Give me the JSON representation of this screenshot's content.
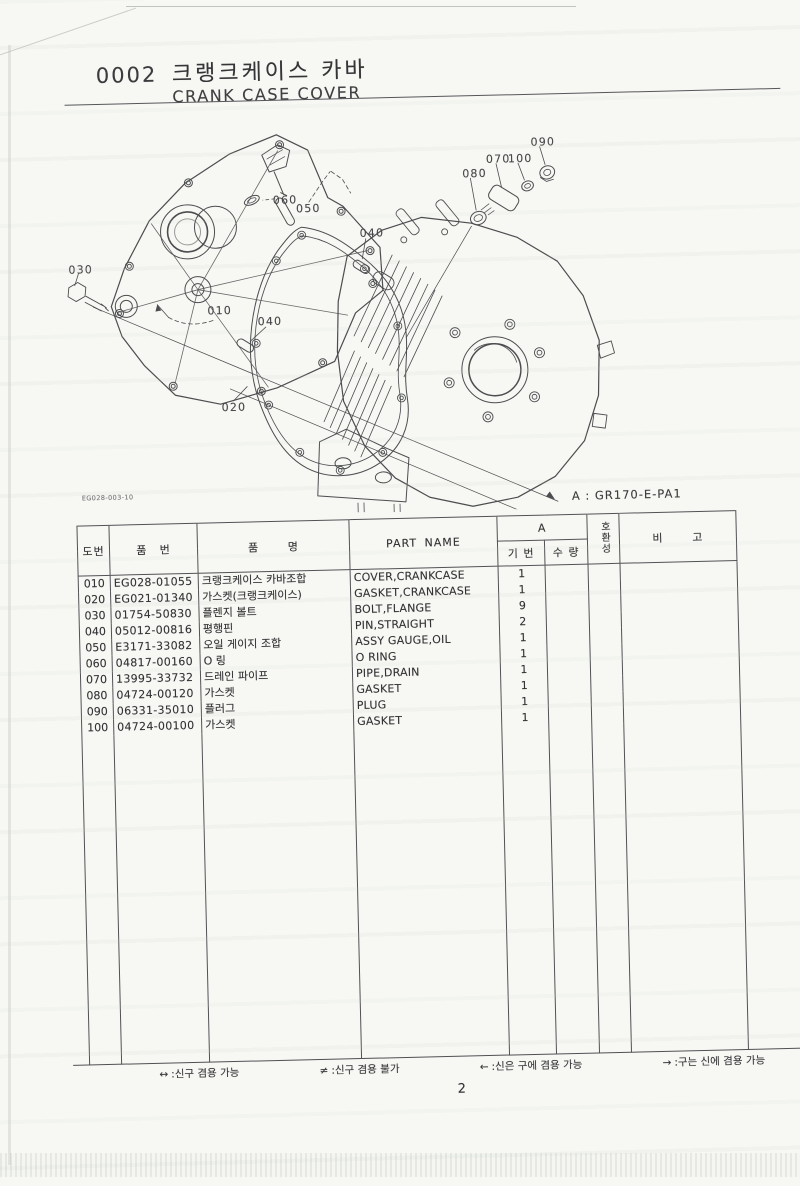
{
  "header": {
    "doc_code": "0002",
    "title_ko": "크랭크케이스 카바",
    "title_en": "CRANK CASE COVER"
  },
  "figure": {
    "ref_code": "EG028-003-10",
    "model_note": "A : GR170-E-PA1",
    "callouts": [
      "030",
      "010",
      "020",
      "040",
      "040",
      "050",
      "060",
      "070",
      "080",
      "090",
      "100"
    ]
  },
  "table": {
    "headers": {
      "doc_no": "도번",
      "part_no": "품 번",
      "name_ko": "품 명",
      "name_en": "PART NAME",
      "variant": "A",
      "ref_no": "기 번",
      "qty": "수 량",
      "compat": "호환성",
      "remarks": "비 고"
    },
    "rows": [
      {
        "no": "010",
        "part_no": "EG028-01055",
        "name_ko": "크랭크케이스 카바조합",
        "name_en": "COVER,CRANKCASE",
        "qty": "1"
      },
      {
        "no": "020",
        "part_no": "EG021-01340",
        "name_ko": "가스켓(크랭크케이스)",
        "name_en": "GASKET,CRANKCASE",
        "qty": "1"
      },
      {
        "no": "030",
        "part_no": "01754-50830",
        "name_ko": "플렌지 볼트",
        "name_en": "BOLT,FLANGE",
        "qty": "9"
      },
      {
        "no": "040",
        "part_no": "05012-00816",
        "name_ko": "평행핀",
        "name_en": "PIN,STRAIGHT",
        "qty": "2"
      },
      {
        "no": "050",
        "part_no": "E3171-33082",
        "name_ko": "오일 게이지 조합",
        "name_en": "ASSY GAUGE,OIL",
        "qty": "1"
      },
      {
        "no": "060",
        "part_no": "04817-00160",
        "name_ko": "O 링",
        "name_en": "O RING",
        "qty": "1"
      },
      {
        "no": "070",
        "part_no": "13995-33732",
        "name_ko": "드레인 파이프",
        "name_en": "PIPE,DRAIN",
        "qty": "1"
      },
      {
        "no": "080",
        "part_no": "04724-00120",
        "name_ko": "가스켓",
        "name_en": "GASKET",
        "qty": "1"
      },
      {
        "no": "090",
        "part_no": "06331-35010",
        "name_ko": "플러그",
        "name_en": "PLUG",
        "qty": "1"
      },
      {
        "no": "100",
        "part_no": "04724-00100",
        "name_ko": "가스켓",
        "name_en": "GASKET",
        "qty": "1"
      }
    ]
  },
  "footer": {
    "legend": [
      {
        "sym": "↔",
        "label": ":신구 겸용 가능"
      },
      {
        "sym": "≠",
        "label": ":신구 겸용 불가"
      },
      {
        "sym": "←",
        "label": ":신은 구에 겸용 가능"
      },
      {
        "sym": "→",
        "label": ":구는 신에 겸용 가능"
      }
    ],
    "page_number": "2"
  },
  "colors": {
    "paper": "#f7f8f4",
    "ink": "#38383a",
    "table_line": "#515255"
  }
}
